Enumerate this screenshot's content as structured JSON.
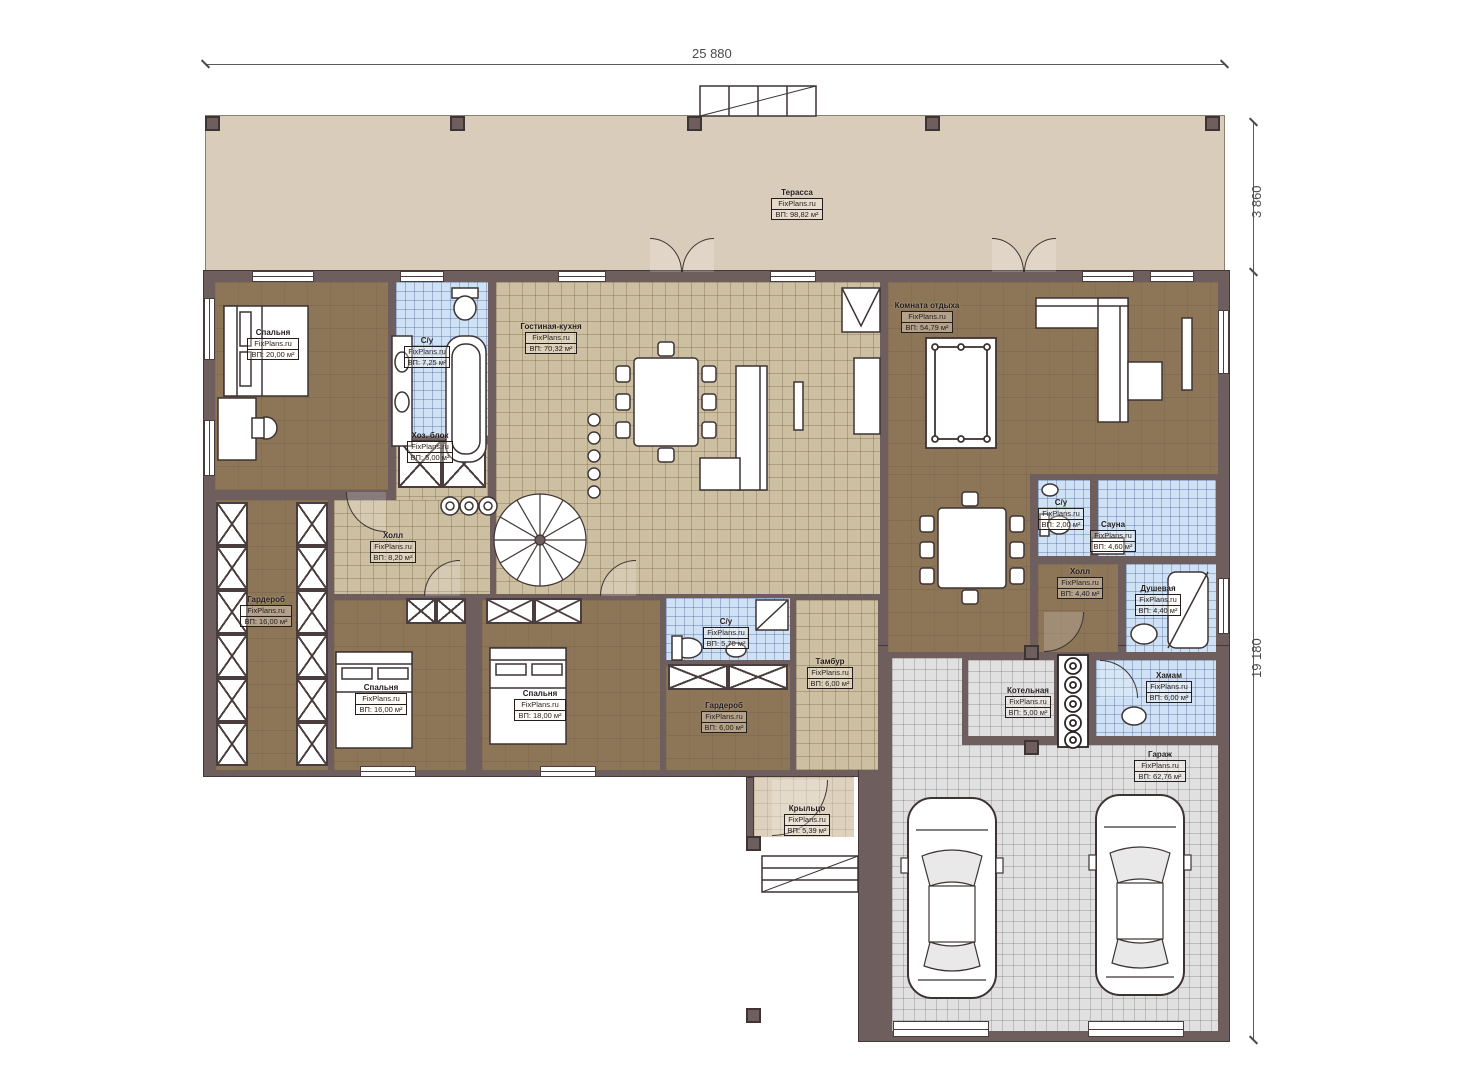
{
  "title": "Floor plan — one-storey house with garage (FixPlans.ru)",
  "watermark": "FixPlans.ru",
  "dimensions": {
    "top_width": "25 880",
    "right_terrace_depth": "3 860",
    "right_house_depth": "19 180"
  },
  "rooms": [
    {
      "name": "Терасса",
      "site": "FixPlans.ru",
      "area": "ВП: 98,82 м²"
    },
    {
      "name": "Спальня",
      "site": "FixPlans.ru",
      "area": "ВП: 20,00 м²"
    },
    {
      "name": "С/у",
      "site": "FixPlans.ru",
      "area": "ВП: 7,25 м²"
    },
    {
      "name": "Хоз. блок",
      "site": "FixPlans.ru",
      "area": "ВП: 5,00 м²"
    },
    {
      "name": "Гостиная-кухня",
      "site": "FixPlans.ru",
      "area": "ВП: 70,32 м²"
    },
    {
      "name": "Комната отдыха",
      "site": "FixPlans.ru",
      "area": "ВП: 54,79 м²"
    },
    {
      "name": "Холл",
      "site": "FixPlans.ru",
      "area": "ВП: 8,20 м²"
    },
    {
      "name": "Гардероб",
      "site": "FixPlans.ru",
      "area": "ВП: 16,00 м²"
    },
    {
      "name": "Спальня",
      "site": "FixPlans.ru",
      "area": "ВП: 16,00 м²"
    },
    {
      "name": "Спальня",
      "site": "FixPlans.ru",
      "area": "ВП: 18,00 м²"
    },
    {
      "name": "С/у",
      "site": "FixPlans.ru",
      "area": "ВП: 5,70 м²"
    },
    {
      "name": "Тамбур",
      "site": "FixPlans.ru",
      "area": "ВП: 6,00 м²"
    },
    {
      "name": "Гардероб",
      "site": "FixPlans.ru",
      "area": "ВП: 6,00 м²"
    },
    {
      "name": "С/у",
      "site": "FixPlans.ru",
      "area": "ВП: 2,00 м²"
    },
    {
      "name": "Сауна",
      "site": "FixPlans.ru",
      "area": "ВП: 4,60 м²"
    },
    {
      "name": "Холл",
      "site": "FixPlans.ru",
      "area": "ВП: 4,40 м²"
    },
    {
      "name": "Душевая",
      "site": "FixPlans.ru",
      "area": "ВП: 4,40 м²"
    },
    {
      "name": "Хамам",
      "site": "FixPlans.ru",
      "area": "ВП: 6,00 м²"
    },
    {
      "name": "Котельная",
      "site": "FixPlans.ru",
      "area": "ВП: 5,00 м²"
    },
    {
      "name": "Гараж",
      "site": "FixPlans.ru",
      "area": "ВП: 62,76 м²"
    },
    {
      "name": "Крыльцо",
      "site": "FixPlans.ru",
      "area": "ВП: 5,39 м²"
    }
  ],
  "colors": {
    "wall": "#6e5e5e",
    "wood_floor": "#8d7557",
    "tile_floor": "#cdbfa1",
    "wet_room_tile": "#cfe2f5",
    "garage_tile": "#e0e0e0",
    "terrace": "#d9ccba",
    "outline": "#3d3434",
    "dimension": "#4a4a4a"
  }
}
